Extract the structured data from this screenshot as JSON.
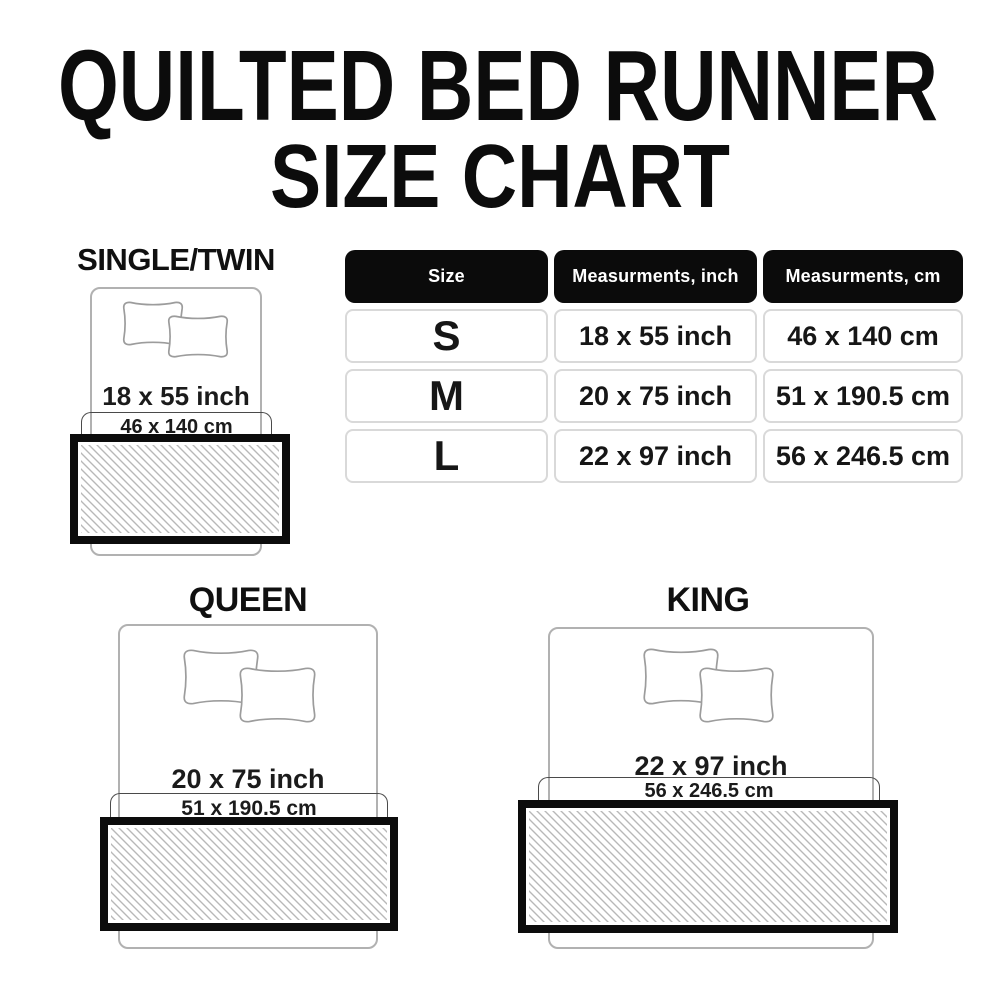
{
  "title": {
    "line1": "QUILTED BED RUNNER",
    "line2": "SIZE CHART"
  },
  "table": {
    "headers": [
      "Size",
      "Measurments, inch",
      "Measurments, cm"
    ],
    "rows": [
      {
        "size": "S",
        "inch": "18 x 55 inch",
        "cm": "46 x 140 cm"
      },
      {
        "size": "M",
        "inch": "20 x 75 inch",
        "cm": "51 x 190.5 cm"
      },
      {
        "size": "L",
        "inch": "22 x 97 inch",
        "cm": "56 x 246.5 cm"
      }
    ]
  },
  "diagrams": {
    "single": {
      "label": "SINGLE/TWIN",
      "inch_label": "18 x 55 inch",
      "cm_label": "46 x 140 cm"
    },
    "queen": {
      "label": "QUEEN",
      "inch_label": "20 x 75 inch",
      "cm_label": "51 x 190.5 cm"
    },
    "king": {
      "label": "KING",
      "inch_label": "22 x 97 inch",
      "cm_label": "56 x 246.5 cm"
    }
  },
  "colors": {
    "ink": "#0c0c0c",
    "header_bg": "#0b0b0b",
    "cell_border": "#d9d9d9",
    "bed_outline": "#b1b1b1",
    "bracket_line": "#4a4a4a",
    "hatch_line": "#b8b8b8"
  }
}
